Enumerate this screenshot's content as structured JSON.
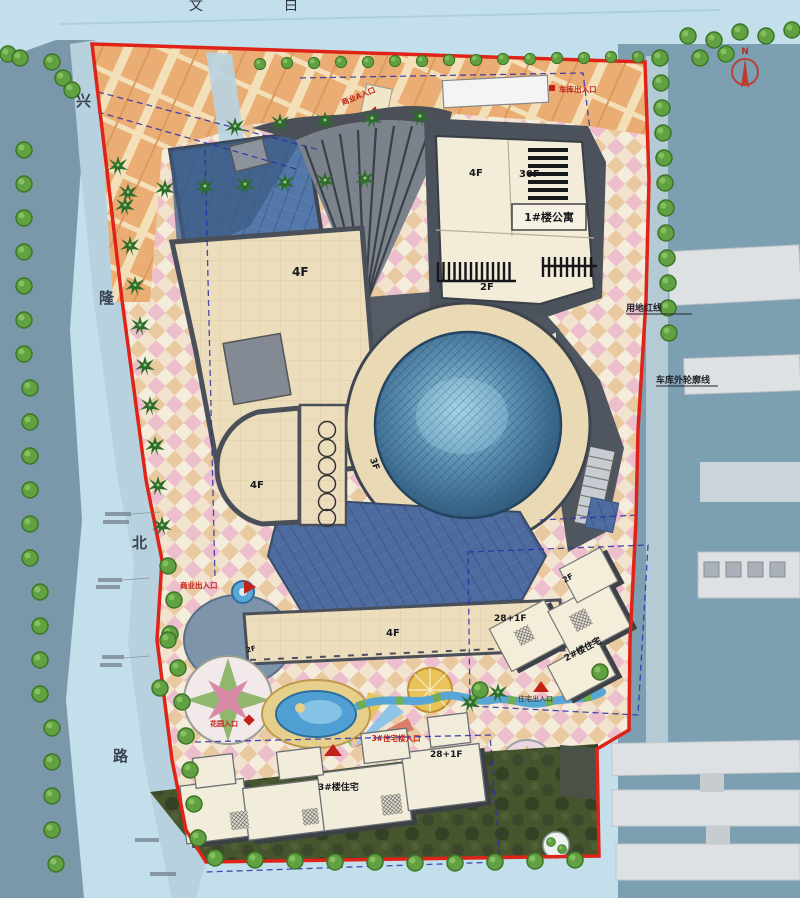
{
  "plan": {
    "north": "N",
    "road": {
      "chars": [
        "兴",
        "隆",
        "北",
        "路"
      ]
    },
    "top_partial": {
      "a": "文",
      "b": "白"
    },
    "markers": {
      "garage_top": "车库出入口",
      "commercial_a": "商业A入口",
      "west": "商业出入口",
      "residence": "住宅出入口",
      "garden": "花园入口",
      "res3": "3#住宅楼入口"
    },
    "lines": {
      "redline": "用地红线",
      "garage_outline": "车库外轮廓线"
    },
    "buildings": {
      "main_4f": "4F",
      "ne_4f": "4F",
      "tower_30f": "30F",
      "apt1": "1#楼公寓",
      "ne_2f": "2F",
      "center_3f": "3F",
      "wing_4f": "4F",
      "bar_4f": "4F",
      "terrace_2f": "2F",
      "res2_2f": "2F",
      "res2_floors": "28+1F",
      "res2_name": "2#楼住宅",
      "res3_floors": "28+1F",
      "res3_name": "3#楼住宅"
    },
    "colors": {
      "boundary_red": "#e02318",
      "marker_red": "#c4201a",
      "garage_dash_blue": "#2a2fa8",
      "water": "#7d9fb2",
      "roof_cream": "#ecdebd",
      "glass_blue": "#5277a8",
      "dome_blue": "#4f7fa6",
      "tree_green": "#61a142",
      "plaza_orange": "#eaae75",
      "dark_roof": "#50565f"
    }
  }
}
